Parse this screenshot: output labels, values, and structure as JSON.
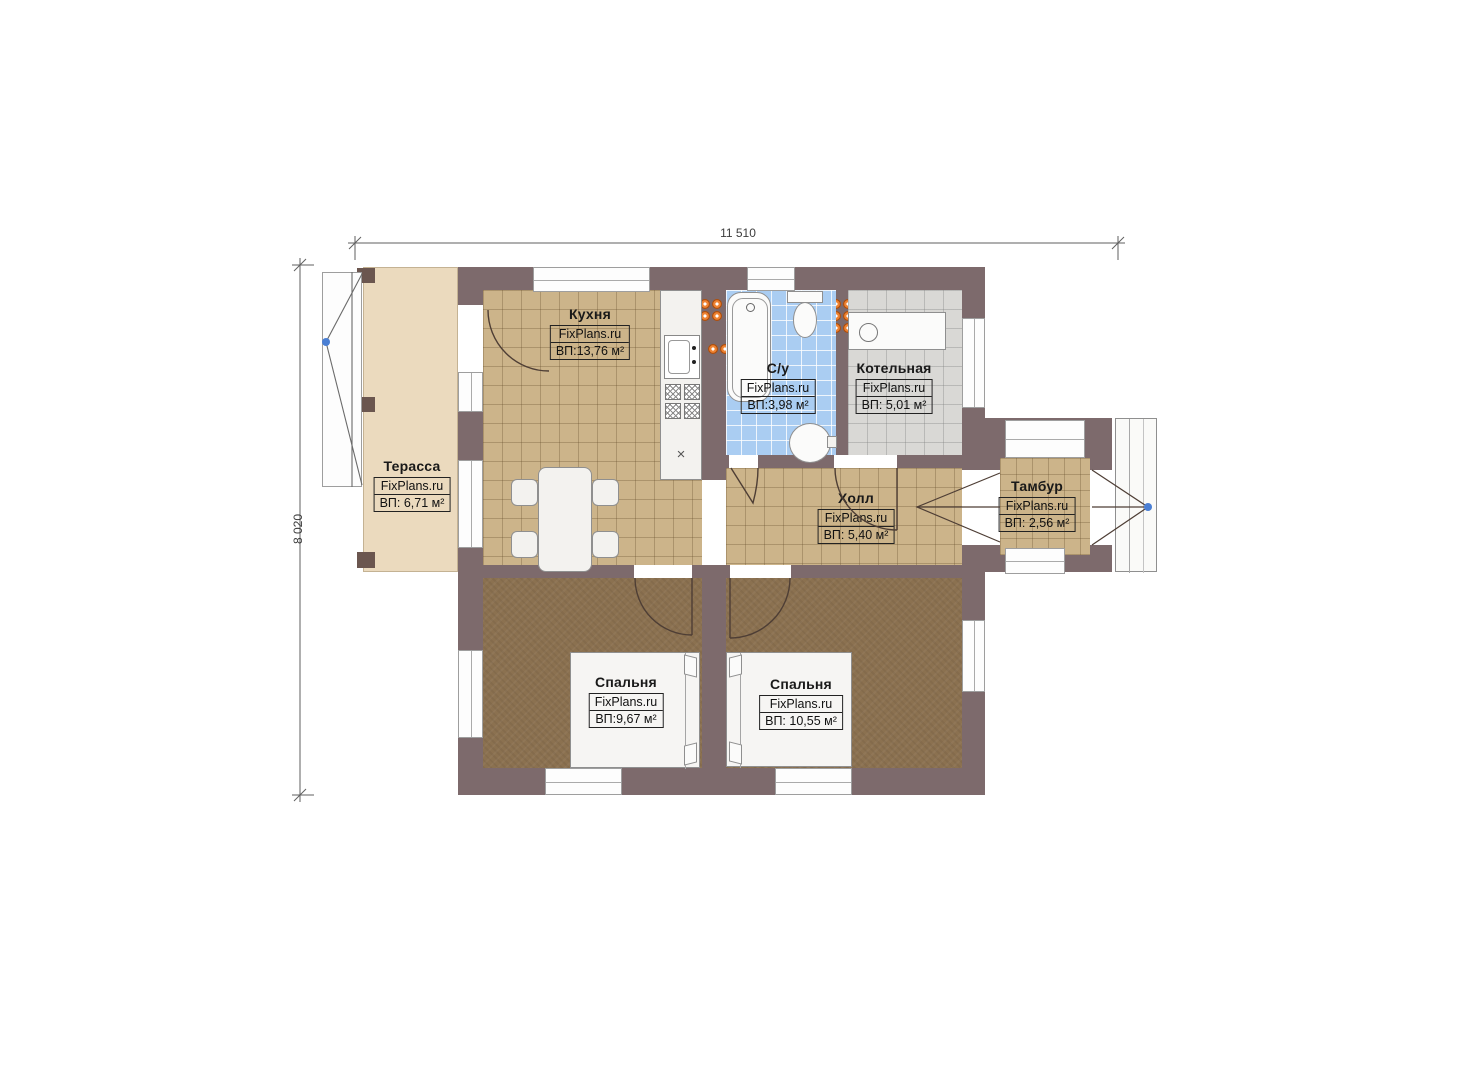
{
  "plan_title": "floor-plan",
  "dimensions": {
    "width_label": "11 510",
    "height_label": "8 020"
  },
  "watermark": "FixPlans.ru",
  "kitchen_counter_mark": "×",
  "rooms": [
    {
      "key": "kitchen",
      "name": "Кухня",
      "brand": "FixPlans.ru",
      "area": "ВП:13,76 м²"
    },
    {
      "key": "bathroom",
      "name": "С/у",
      "brand": "FixPlans.ru",
      "area": "ВП:3,98 м²"
    },
    {
      "key": "boiler",
      "name": "Котельная",
      "brand": "FixPlans.ru",
      "area": "ВП: 5,01 м²"
    },
    {
      "key": "terrace",
      "name": "Терасса",
      "brand": "FixPlans.ru",
      "area": "ВП: 6,71 м²"
    },
    {
      "key": "hall",
      "name": "Холл",
      "brand": "FixPlans.ru",
      "area": "ВП: 5,40 м²"
    },
    {
      "key": "vestibule",
      "name": "Тамбур",
      "brand": "FixPlans.ru",
      "area": "ВП: 2,56 м²"
    },
    {
      "key": "bedroom1",
      "name": "Спальня",
      "brand": "FixPlans.ru",
      "area": "ВП:9,67 м²"
    },
    {
      "key": "bedroom2",
      "name": "Спальня",
      "brand": "FixPlans.ru",
      "area": "ВП: 10,55 м²"
    }
  ],
  "colors": {
    "wall": "#7d6a6c",
    "floor_tan": "#ccb48a",
    "floor_blue": "#aacdf2",
    "floor_gray": "#d9d8d5",
    "floor_brown": "#8b7150",
    "terrace": "#ebdabe",
    "radiator_orange": "#ef8434",
    "door_dot_blue": "#4a7fd4"
  }
}
